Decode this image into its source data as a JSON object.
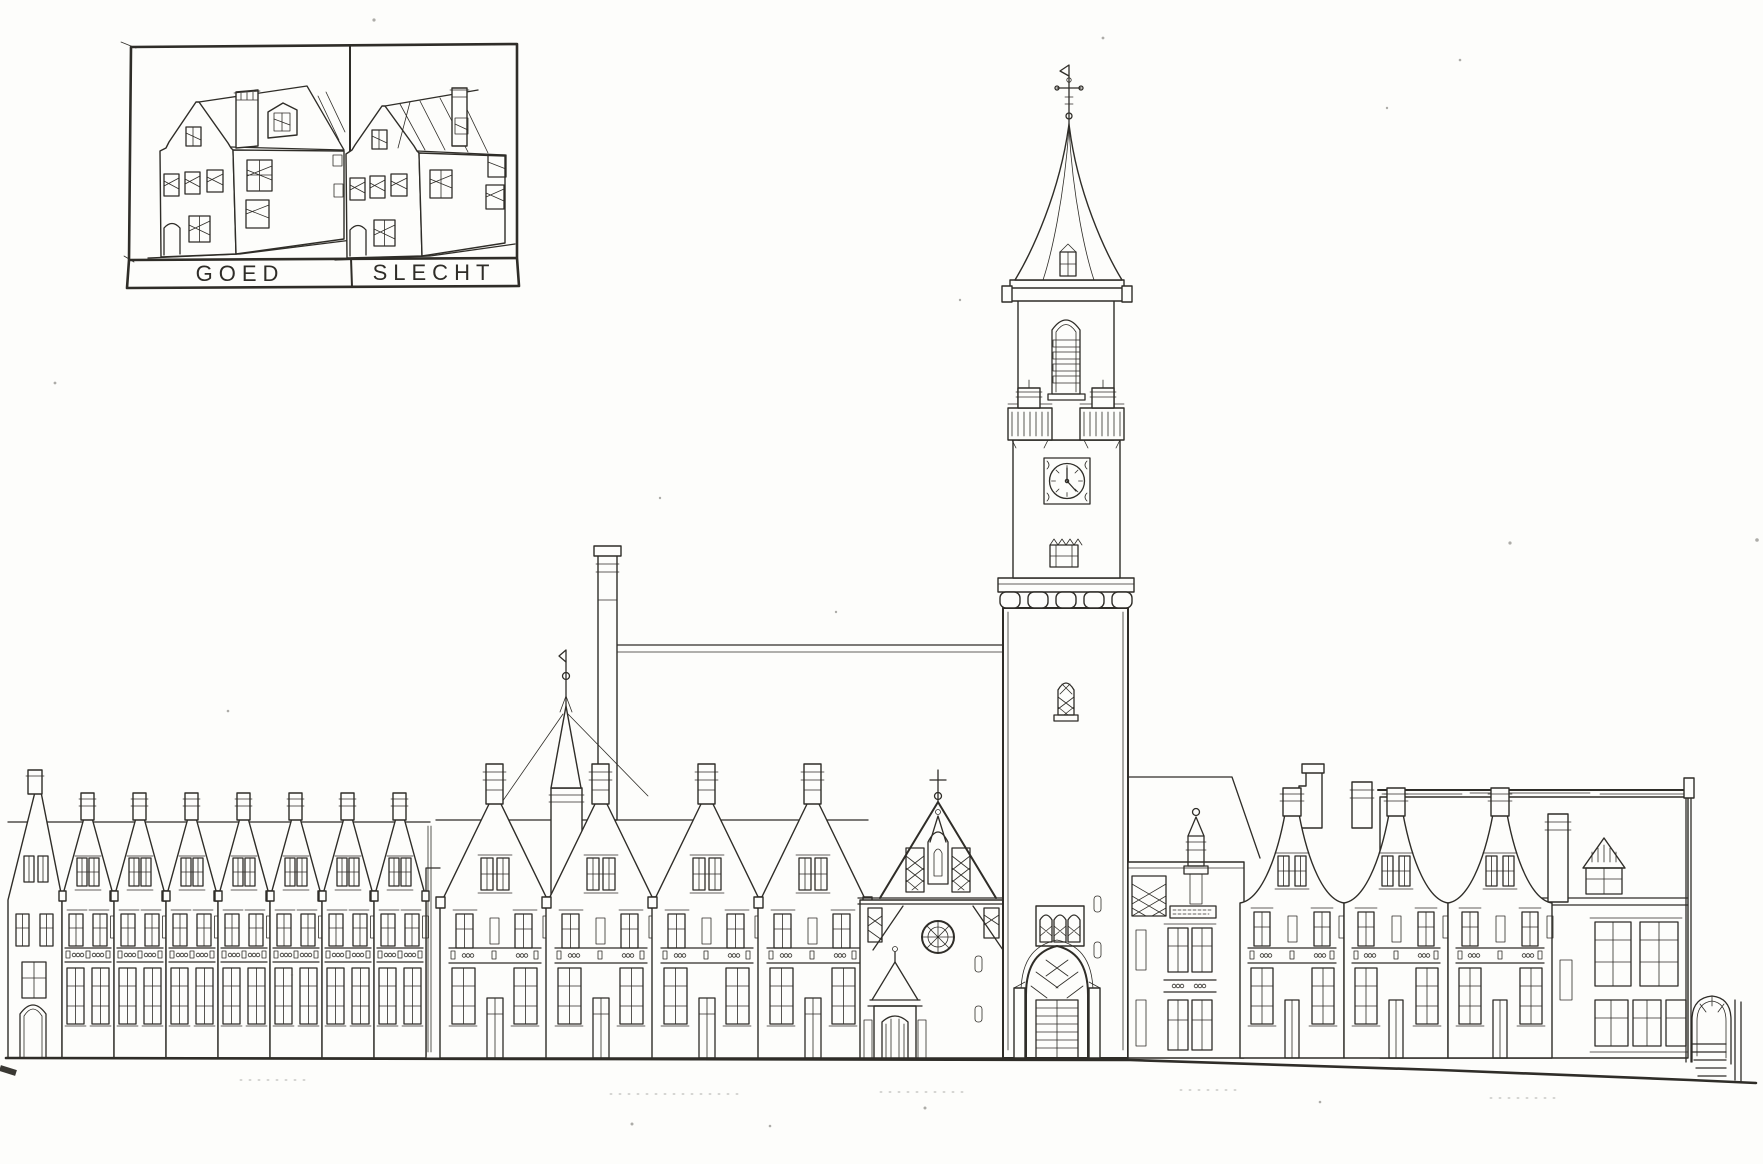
{
  "page": {
    "background_color": "#fdfdfb",
    "ink_color": "#2f2d28",
    "description": "Hand-drawn black-ink street elevation: rows of gabled houses flanking a church clock tower with tall spire; comparison inset at top-left"
  },
  "inset": {
    "left_panel_label": "GOED",
    "right_panel_label": "SLECHT"
  },
  "tower_clock": {
    "depicted_time": "5:00"
  }
}
